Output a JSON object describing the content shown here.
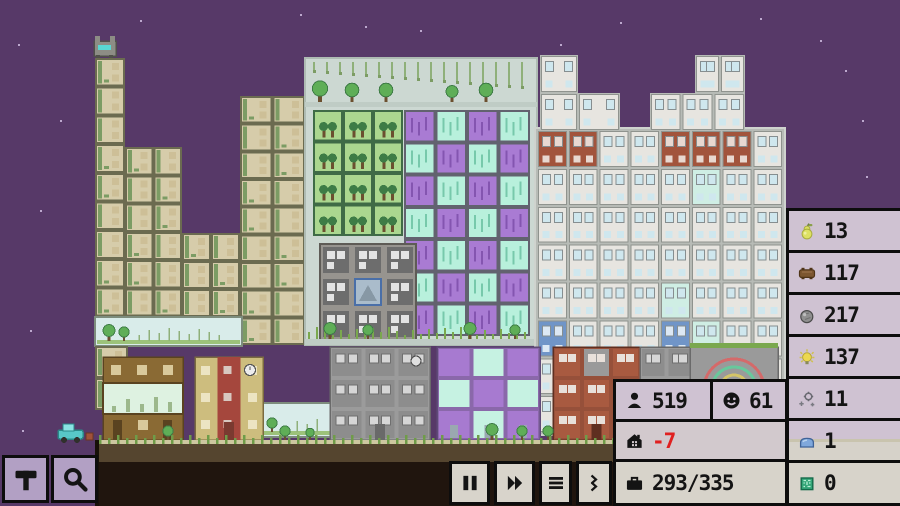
{
  "hud": {
    "resources": [
      {
        "name": "food",
        "icon": "pear-icon",
        "value": "13"
      },
      {
        "name": "wood",
        "icon": "wood-icon",
        "value": "117"
      },
      {
        "name": "stone",
        "icon": "stone-icon",
        "value": "217"
      },
      {
        "name": "energy",
        "icon": "lightbulb-icon",
        "value": "137"
      },
      {
        "name": "machine-parts",
        "icon": "machine-parts-icon",
        "value": "11"
      },
      {
        "name": "plastic",
        "icon": "plastic-icon",
        "value": "1"
      },
      {
        "name": "computer-chips",
        "icon": "chip-icon",
        "value": "0"
      }
    ],
    "stats": {
      "population": {
        "icon": "person-icon",
        "value": "519"
      },
      "happiness": {
        "icon": "smiley-icon",
        "value": "61"
      },
      "housing": {
        "icon": "house-icon",
        "value": "-7",
        "negative": true
      },
      "workers": {
        "icon": "briefcase-icon",
        "value": "293/335"
      }
    },
    "controls": [
      {
        "name": "pause",
        "icon": "pause-icon"
      },
      {
        "name": "fast-forward",
        "icon": "fast-forward-icon"
      },
      {
        "name": "menu",
        "icon": "menu-icon"
      },
      {
        "name": "expand",
        "icon": "chevrons-icon"
      }
    ],
    "tools": [
      {
        "name": "build",
        "icon": "hammer-icon"
      },
      {
        "name": "inspect",
        "icon": "magnifier-icon"
      }
    ],
    "colors": {
      "panel_lavender": "#cfc2d2",
      "panel_grey": "#d7d3ca",
      "border": "#0d0d0d",
      "negative_text": "#e02020",
      "tool_button": "#b2a0c4",
      "speed_button": "#d8d4cb"
    }
  },
  "city": {
    "sky": "#573968",
    "stars": [
      [
        18,
        44
      ],
      [
        140,
        20
      ],
      [
        300,
        14
      ],
      [
        60,
        120
      ],
      [
        40,
        210
      ],
      [
        250,
        152
      ],
      [
        420,
        30
      ],
      [
        560,
        44
      ],
      [
        620,
        22
      ],
      [
        700,
        80
      ],
      [
        760,
        18
      ],
      [
        820,
        40
      ],
      [
        862,
        120
      ],
      [
        866,
        176
      ],
      [
        30,
        330
      ],
      [
        22,
        430
      ],
      [
        120,
        262
      ],
      [
        845,
        70
      ],
      [
        445,
        86
      ],
      [
        365,
        26
      ]
    ],
    "ground": {
      "grass_line": "#cdc7a0",
      "tuft": "#6f9c49",
      "dirt": "#55452f",
      "underground": "#20150e",
      "left": 95,
      "top": 440
    },
    "sections": [
      {
        "t": "eco",
        "x": 95,
        "y": 58,
        "w": 30,
        "h": 287
      },
      {
        "t": "eco",
        "x": 125,
        "y": 147,
        "w": 57,
        "h": 198
      },
      {
        "t": "eco",
        "x": 182,
        "y": 233,
        "w": 58,
        "h": 112
      },
      {
        "t": "eco",
        "x": 240,
        "y": 96,
        "w": 65,
        "h": 249
      },
      {
        "t": "park",
        "x": 95,
        "y": 317,
        "w": 147,
        "h": 29
      },
      {
        "t": "eco",
        "x": 95,
        "y": 346,
        "w": 33,
        "h": 64
      },
      {
        "t": "slab",
        "x": 305,
        "y": 58,
        "w": 232,
        "h": 287,
        "c": "#ccd8d2",
        "b": "#aebbb3"
      },
      {
        "t": "ledge",
        "x": 305,
        "y": 102,
        "w": 232,
        "h": 5
      },
      {
        "t": "vines",
        "x": 310,
        "y": 62,
        "w": 222,
        "h": 34
      },
      {
        "t": "farm",
        "x": 313,
        "y": 110,
        "w": 90,
        "h": 126
      },
      {
        "t": "lab",
        "x": 404,
        "y": 110,
        "w": 126,
        "h": 226
      },
      {
        "t": "factory",
        "x": 320,
        "y": 244,
        "w": 96,
        "h": 96
      },
      {
        "t": "scrub",
        "x": 306,
        "y": 325,
        "w": 230,
        "h": 14
      },
      {
        "t": "ledge",
        "x": 305,
        "y": 339,
        "w": 232,
        "h": 6
      },
      {
        "t": "park",
        "x": 243,
        "y": 403,
        "w": 92,
        "h": 34
      },
      {
        "t": "slab",
        "x": 535,
        "y": 128,
        "w": 250,
        "h": 307,
        "c": "#b7bbb6",
        "b": "#cfd3ce"
      },
      {
        "t": "apt",
        "x": 540,
        "y": 55,
        "w": 38,
        "h": 76
      },
      {
        "t": "apt",
        "x": 578,
        "y": 93,
        "w": 42,
        "h": 38
      },
      {
        "t": "apt",
        "x": 695,
        "y": 55,
        "w": 50,
        "h": 76
      },
      {
        "t": "apt",
        "x": 650,
        "y": 93,
        "w": 95,
        "h": 38
      },
      {
        "t": "apt",
        "x": 537,
        "y": 130,
        "w": 246,
        "h": 303,
        "reds": [
          [
            0,
            0
          ],
          [
            0,
            1
          ],
          [
            0,
            4
          ],
          [
            0,
            5
          ],
          [
            0,
            6
          ]
        ],
        "blues": [
          [
            5,
            0
          ],
          [
            5,
            4
          ]
        ]
      },
      {
        "t": "shop",
        "x": 103,
        "y": 357,
        "w": 80,
        "h": 83
      },
      {
        "t": "school",
        "x": 195,
        "y": 357,
        "w": 68,
        "h": 83
      },
      {
        "t": "grey",
        "x": 330,
        "y": 347,
        "w": 100,
        "h": 93
      },
      {
        "t": "labst",
        "x": 437,
        "y": 347,
        "w": 103,
        "h": 93
      },
      {
        "t": "red",
        "x": 553,
        "y": 347,
        "w": 87,
        "h": 93
      },
      {
        "t": "grey",
        "x": 640,
        "y": 347,
        "w": 80,
        "h": 93
      },
      {
        "t": "fun",
        "x": 690,
        "y": 347,
        "w": 88,
        "h": 93
      }
    ],
    "trees": [
      {
        "x": 320,
        "y": 102,
        "s": 9
      },
      {
        "x": 352,
        "y": 102,
        "s": 8
      },
      {
        "x": 386,
        "y": 102,
        "s": 8
      },
      {
        "x": 452,
        "y": 102,
        "s": 7
      },
      {
        "x": 486,
        "y": 102,
        "s": 8
      },
      {
        "x": 330,
        "y": 339,
        "s": 7
      },
      {
        "x": 368,
        "y": 339,
        "s": 6
      },
      {
        "x": 470,
        "y": 339,
        "s": 7
      },
      {
        "x": 515,
        "y": 339,
        "s": 6
      },
      {
        "x": 168,
        "y": 440,
        "s": 6
      },
      {
        "x": 285,
        "y": 440,
        "s": 6
      },
      {
        "x": 310,
        "y": 440,
        "s": 5
      },
      {
        "x": 492,
        "y": 440,
        "s": 7
      },
      {
        "x": 522,
        "y": 440,
        "s": 6
      },
      {
        "x": 548,
        "y": 440,
        "s": 6
      },
      {
        "x": 662,
        "y": 440,
        "s": 7
      }
    ],
    "sprites": {
      "cat": {
        "x": 94,
        "y": 37
      },
      "vehicle": {
        "x": 58,
        "y": 424
      }
    }
  }
}
